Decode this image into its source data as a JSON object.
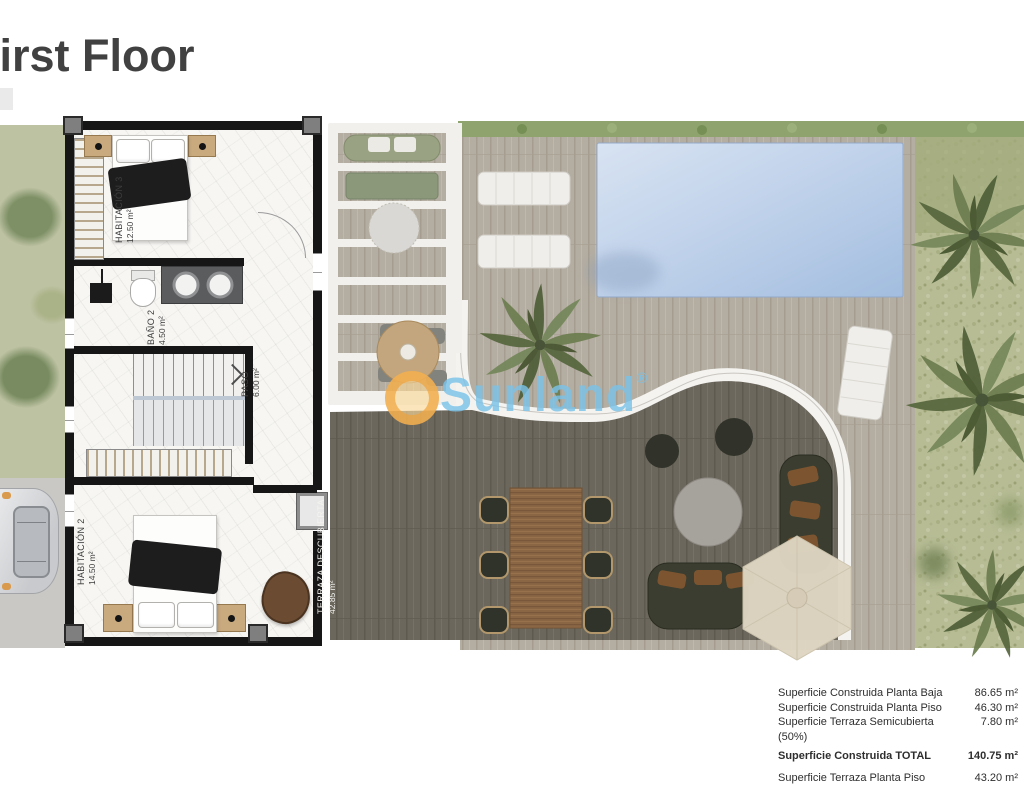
{
  "title": "First Floor",
  "watermark": {
    "text": "Sunland",
    "registered": "®",
    "blue": "#7ac2e8",
    "orange": "#f0a33c"
  },
  "rooms": [
    {
      "name": "HABITACIÓN 3",
      "area": "12.50 m²"
    },
    {
      "name": "BAÑO 2",
      "area": "4.50 m²"
    },
    {
      "name": "PASO",
      "area": "6.00 m²"
    },
    {
      "name": "HABITACIÓN 2",
      "area": "14.50 m²"
    },
    {
      "name": "TERRAZA DESCUBIERTA",
      "area": "42.85 m²"
    }
  ],
  "area_table": {
    "rows": [
      {
        "label": "Superficie Construida Planta Baja",
        "value": "86.65 m²"
      },
      {
        "label": "Superficie Construida Planta Piso",
        "value": "46.30 m²"
      },
      {
        "label": "Superficie Terraza Semicubierta (50%)",
        "value": "7.80 m²"
      },
      {
        "label": "Superficie Construida TOTAL",
        "value": "140.75 m²"
      },
      {
        "label": "Superficie Terraza Planta Piso",
        "value": "43.20 m²"
      }
    ]
  },
  "colors": {
    "wall": "#161616",
    "pool": "#b6cbe7",
    "deck_light": "#b4ada1",
    "deck_dark": "#6b675d",
    "grass": "#b9be9c",
    "hedge": "#8ea36d",
    "parasol": "#ded5c2",
    "table_wood": "#8a6644"
  }
}
